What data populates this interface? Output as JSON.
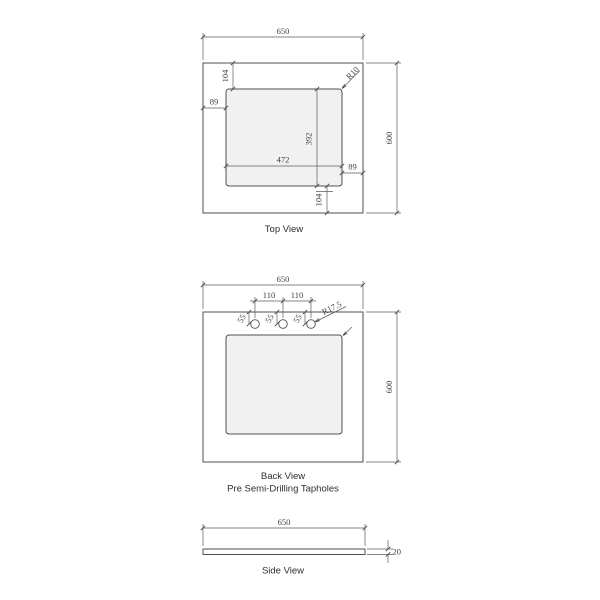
{
  "drawing_title": "Vanity top technical drawing",
  "views": {
    "top": {
      "caption": "Top View",
      "dim_width": "650",
      "dim_height": "600",
      "dim_top_offset": "104",
      "dim_left_offset": "89",
      "dim_corner_radius": "R10",
      "dim_cutout_height": "392",
      "dim_cutout_width": "472",
      "dim_right_offset": "89",
      "dim_bottom_offset": "104"
    },
    "back": {
      "caption": "Back View",
      "subcaption": "Pre Semi-Drilling Tapholes",
      "dim_width": "650",
      "dim_height": "600",
      "dim_hole_spacing_1": "110",
      "dim_hole_spacing_2": "110",
      "dim_hole_offset_1": "55",
      "dim_hole_offset_2": "55",
      "dim_hole_offset_3": "55",
      "dim_hole_radius": "R17.5"
    },
    "side": {
      "caption": "Side View",
      "dim_width": "650",
      "dim_thickness": "20"
    }
  },
  "colors": {
    "object_line": "#4f4f4f",
    "dimension_line": "#5c5c5c",
    "cutout_fill": "#f1f1f1",
    "text": "#3f3f3f",
    "background": "#ffffff"
  }
}
